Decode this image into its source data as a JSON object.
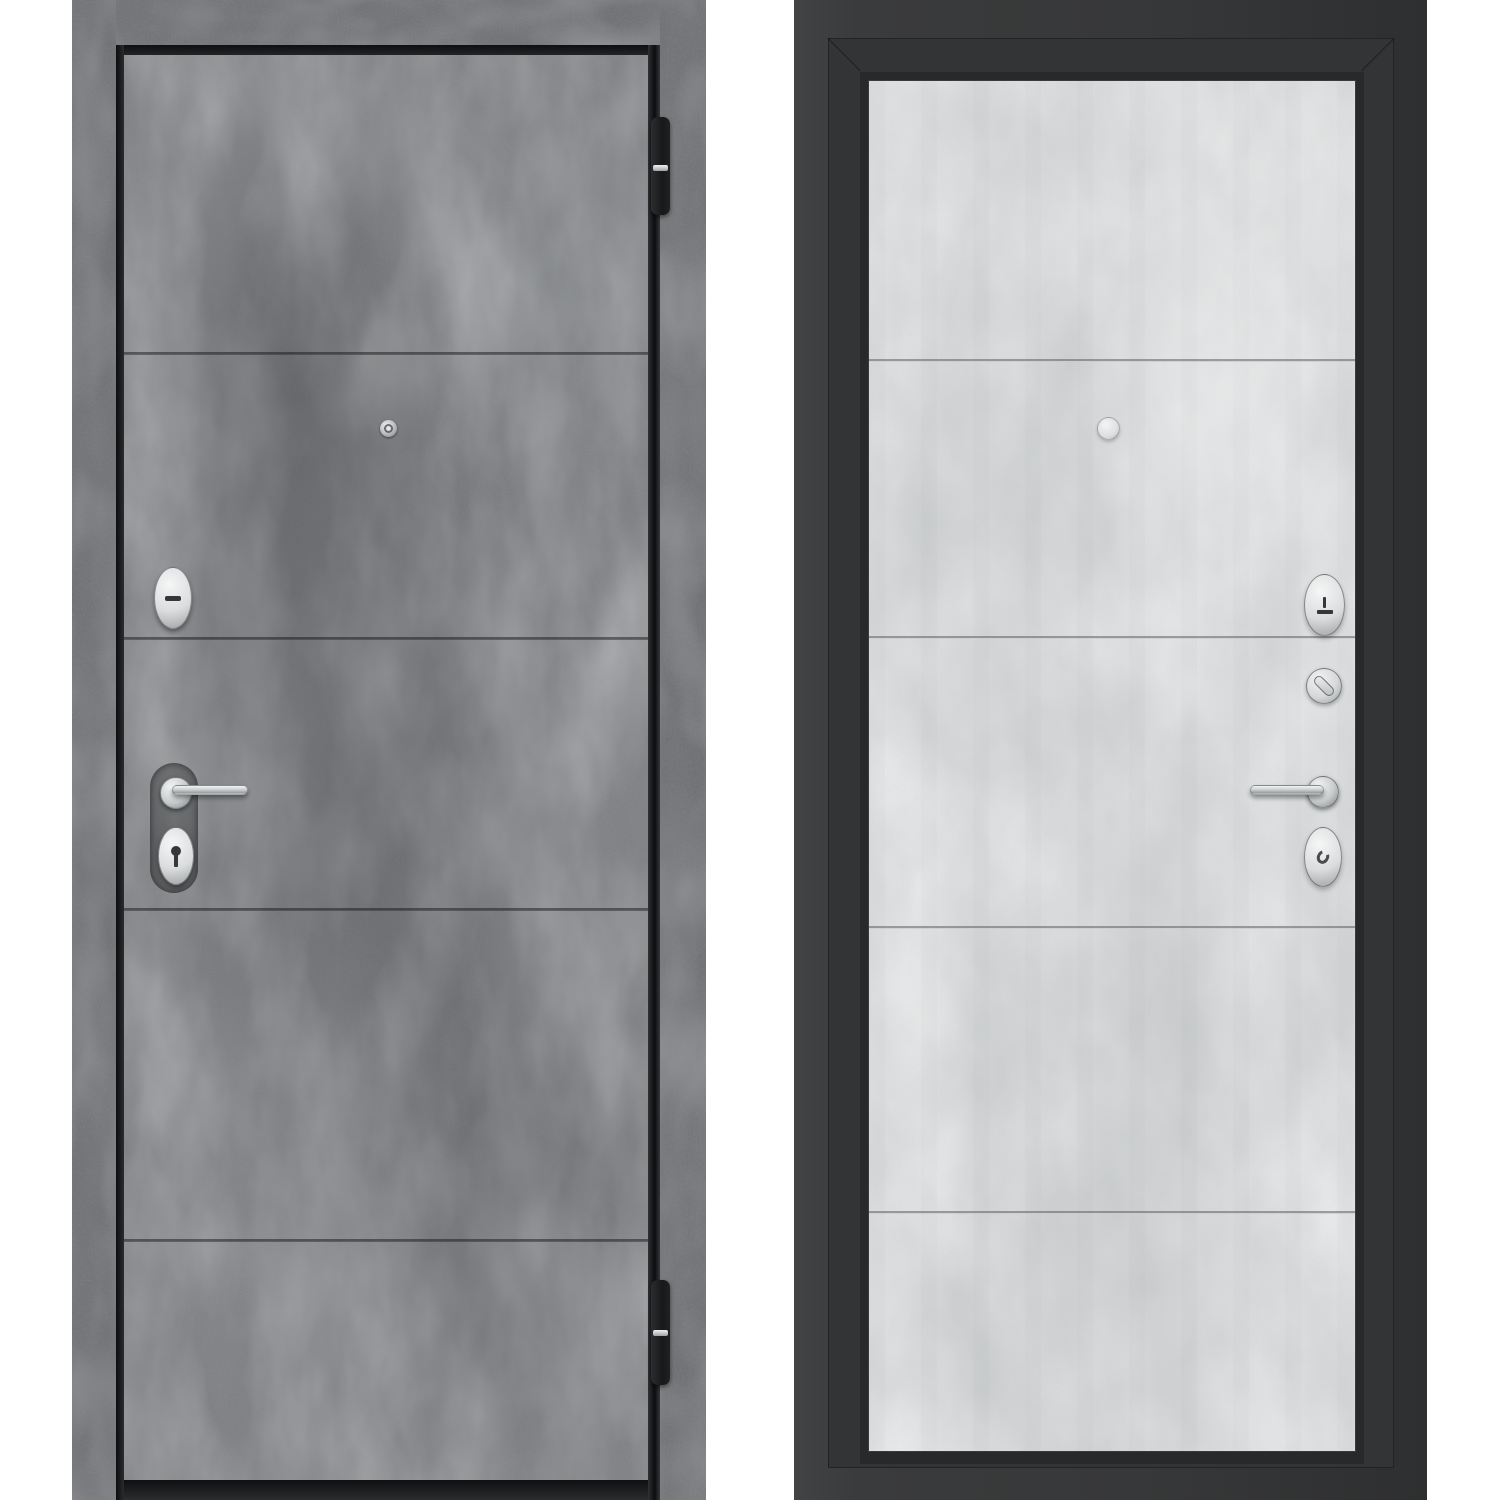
{
  "page": {
    "background": "#ffffff",
    "description": "Product photo of a steel entrance door shown from both sides: exterior face in dark concrete finish, interior face in light concrete finish with black frame"
  },
  "colors": {
    "white_bg": "#ffffff",
    "exterior_base": "#797b7e",
    "exterior_dark": "#4c4e51",
    "exterior_light": "#b6b9bc",
    "exterior_frame_base": "#6f7174",
    "interior_leaf_base": "#d2d4d5",
    "interior_dark": "#9da0a2",
    "interior_light": "#f0f1f1",
    "frame_black": "#38393a",
    "frame_black_dark": "#2a2b2c",
    "gap_black": "#141516",
    "hinge_black": "#1f2022",
    "silver": "#d8dadb",
    "silver_deep": "#979a9d",
    "glyph_dark": "#35373a"
  },
  "exterior_view": {
    "name": "door-exterior-dark-concrete",
    "finish": "dark concrete panels",
    "panel_seam_count": 4,
    "hardware": [
      "door-frame",
      "door-leaf",
      "top-hinge",
      "bottom-hinge",
      "peephole",
      "lock-escutcheon-oval",
      "handle-recess",
      "lever-handle",
      "cylinder-escutcheon-oval"
    ]
  },
  "interior_view": {
    "name": "door-interior-light-concrete",
    "finish": "light concrete panels, black frame",
    "panel_seam_count": 4,
    "hardware": [
      "door-frame",
      "door-leaf",
      "peephole-cover",
      "lock-escutcheon-oval",
      "thumbturn",
      "lever-handle",
      "cylinder-escutcheon-oval"
    ]
  }
}
